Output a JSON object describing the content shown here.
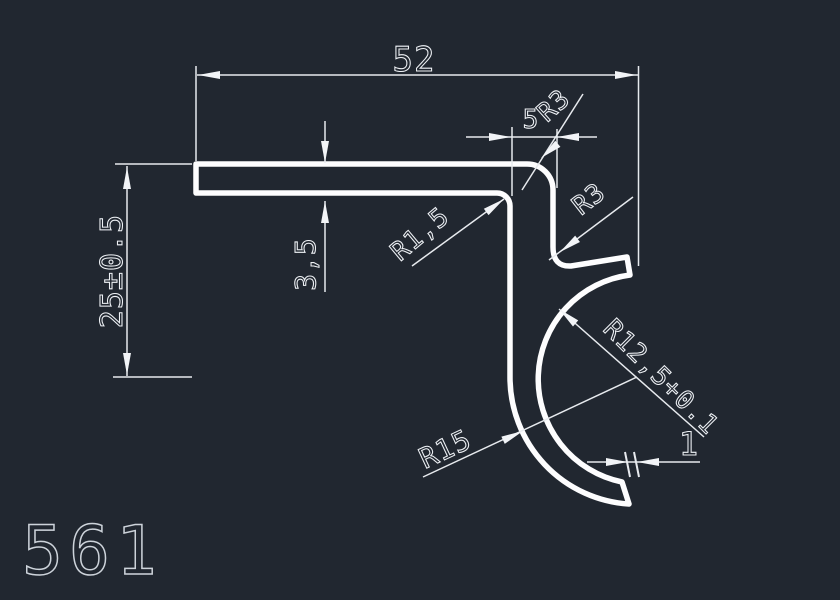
{
  "canvas": {
    "background_color": "#212730",
    "profile_color": "#fdfdfe",
    "dimension_color": "#e7eaee"
  },
  "drawing": {
    "part_number": "561",
    "type": "profile-cross-section"
  },
  "dimensions": {
    "overall_width": "52",
    "overall_height": "25±0.5",
    "bar_thickness": "3,5",
    "hook_offset": "5",
    "top_corner_radius": "R3",
    "s_curve_radius": "R3",
    "inner_fillet_radius": "R1,5",
    "bowl_outer_radius": "R15",
    "bowl_inner_radius": "R12,5+0.1",
    "tip_thickness": "1"
  }
}
